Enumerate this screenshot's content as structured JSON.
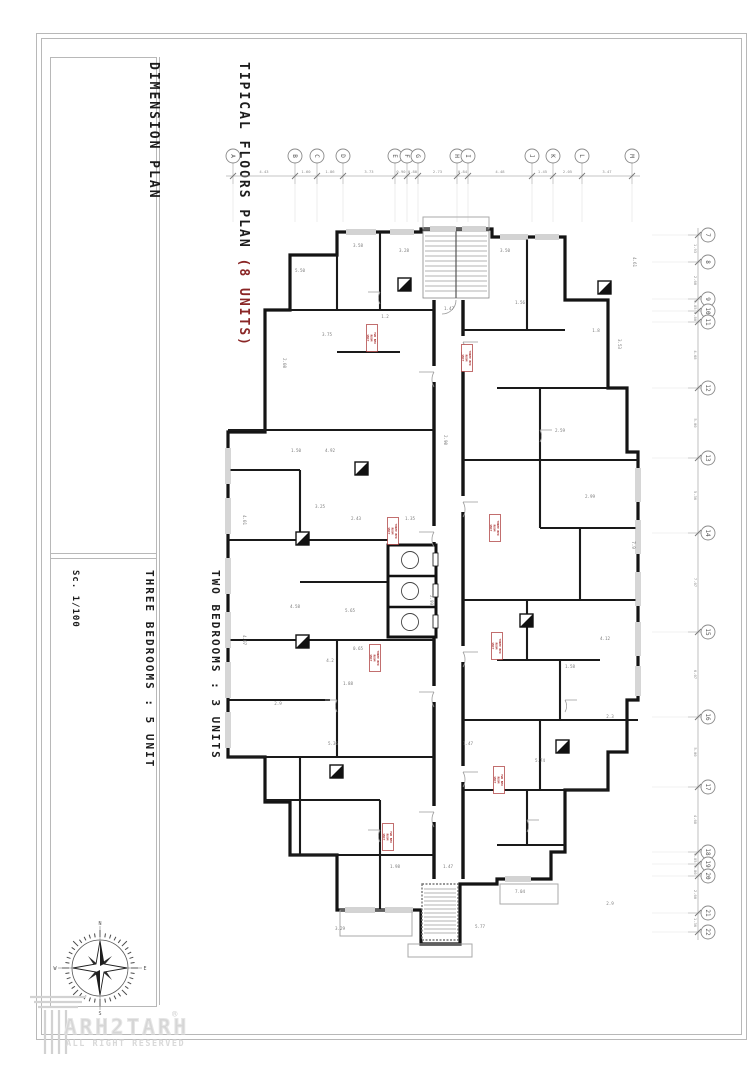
{
  "page": {
    "bg": "#ffffff",
    "frame_color": "#b8b8b8",
    "wall_color": "#141414"
  },
  "title_block": {
    "title_main": "TIPICAL FLOORS PLAN ",
    "title_accent": "(8 UNITS)",
    "accent_color": "#8a2626",
    "subtitle": "DIMENSION PLAN",
    "legend": [
      {
        "label": "TWO BEDROOMS : 3 UNITS"
      },
      {
        "label": "THREE BEDROOMS : 5 UNIT"
      }
    ],
    "scale": "Sc. 1/100"
  },
  "logo": {
    "name": "ARH2TARH",
    "registered": "®",
    "tagline": "ALL RIGHT RESERVED",
    "color": "#d6d6d6"
  },
  "compass": {
    "cardinals": {
      "n": "N",
      "e": "E",
      "s": "S",
      "w": "W"
    }
  },
  "grid": {
    "top": {
      "labels": [
        "A",
        "B",
        "C",
        "D",
        "E",
        "F",
        "G",
        "H",
        "I",
        "J",
        "K",
        "L",
        "M"
      ],
      "x": [
        233,
        295,
        317,
        343,
        395,
        407,
        418,
        457,
        468,
        532,
        553,
        582,
        632
      ],
      "dims": [
        "4.43",
        "1.60",
        "1.86",
        "3.73",
        "0.90",
        "0.80",
        "2.73",
        "0.84",
        "4.48",
        "1.45",
        "2.05",
        "3.47"
      ]
    },
    "right": {
      "labels": [
        "7",
        "8",
        "9",
        "10",
        "11",
        "12",
        "13",
        "14",
        "15",
        "16",
        "17",
        "18",
        "19",
        "20",
        "21",
        "22"
      ],
      "y": [
        235,
        262,
        299,
        311,
        322,
        388,
        458,
        533,
        632,
        717,
        787,
        852,
        864,
        876,
        913,
        932
      ],
      "dims": [
        "1.93",
        "2.60",
        "0.85",
        "0.80",
        "4.68",
        "5.00",
        "5.36",
        "7.07",
        "6.07",
        "5.00",
        "4.68",
        "0.85",
        "0.80",
        "2.60",
        "1.36"
      ]
    }
  },
  "plan": {
    "tag_color": "#a93232",
    "unit_tags": [
      {
        "x": 372,
        "y": 338,
        "lines": [
          "TWO BED",
          "ROOM",
          "UNIT"
        ]
      },
      {
        "x": 467,
        "y": 358,
        "lines": [
          "THREE BED",
          "ROOM",
          "UNIT"
        ]
      },
      {
        "x": 393,
        "y": 531,
        "lines": [
          "THREE BED",
          "ROOM",
          "UNIT"
        ]
      },
      {
        "x": 495,
        "y": 528,
        "lines": [
          "THREE BED",
          "ROOM",
          "UNIT"
        ]
      },
      {
        "x": 497,
        "y": 646,
        "lines": [
          "THREE BED",
          "ROOM",
          "UNIT"
        ]
      },
      {
        "x": 375,
        "y": 658,
        "lines": [
          "THREE BED",
          "ROOM",
          "UNIT"
        ]
      },
      {
        "x": 499,
        "y": 780,
        "lines": [
          "TWO BED",
          "ROOM",
          "UNIT"
        ]
      },
      {
        "x": 388,
        "y": 837,
        "lines": [
          "TWO BED",
          "ROOM",
          "UNIT"
        ]
      }
    ],
    "dims": [
      {
        "x": 404,
        "y": 252,
        "v": "3.28",
        "r": 0
      },
      {
        "x": 505,
        "y": 252,
        "v": "3.50",
        "r": 0
      },
      {
        "x": 300,
        "y": 272,
        "v": "5.50",
        "r": 0
      },
      {
        "x": 358,
        "y": 247,
        "v": "3.58",
        "r": 0
      },
      {
        "x": 633,
        "y": 262,
        "v": "4.61",
        "r": 1
      },
      {
        "x": 449,
        "y": 310,
        "v": "1.47",
        "r": 0
      },
      {
        "x": 385,
        "y": 318,
        "v": "1.2",
        "r": 0
      },
      {
        "x": 327,
        "y": 336,
        "v": "3.75",
        "r": 0
      },
      {
        "x": 283,
        "y": 363,
        "v": "2.08",
        "r": 1
      },
      {
        "x": 618,
        "y": 344,
        "v": "3.53",
        "r": 1
      },
      {
        "x": 520,
        "y": 304,
        "v": "1.56",
        "r": 0
      },
      {
        "x": 596,
        "y": 332,
        "v": "1.8",
        "r": 0
      },
      {
        "x": 444,
        "y": 440,
        "v": "2.90",
        "r": 1
      },
      {
        "x": 330,
        "y": 452,
        "v": "4.92",
        "r": 0
      },
      {
        "x": 296,
        "y": 452,
        "v": "1.50",
        "r": 0
      },
      {
        "x": 243,
        "y": 520,
        "v": "4.01",
        "r": 1
      },
      {
        "x": 320,
        "y": 508,
        "v": "3.25",
        "r": 0
      },
      {
        "x": 356,
        "y": 520,
        "v": "2.43",
        "r": 0
      },
      {
        "x": 410,
        "y": 520,
        "v": "1.35",
        "r": 0
      },
      {
        "x": 560,
        "y": 432,
        "v": "2.59",
        "r": 0
      },
      {
        "x": 590,
        "y": 498,
        "v": "2.99",
        "r": 0
      },
      {
        "x": 632,
        "y": 545,
        "v": "7.9",
        "r": 1
      },
      {
        "x": 295,
        "y": 608,
        "v": "4.58",
        "r": 0
      },
      {
        "x": 350,
        "y": 612,
        "v": "5.65",
        "r": 0
      },
      {
        "x": 243,
        "y": 640,
        "v": "4.07",
        "r": 1
      },
      {
        "x": 330,
        "y": 662,
        "v": "4.2",
        "r": 0
      },
      {
        "x": 358,
        "y": 650,
        "v": "0.65",
        "r": 0
      },
      {
        "x": 348,
        "y": 685,
        "v": "1.88",
        "r": 0
      },
      {
        "x": 278,
        "y": 705,
        "v": "2.9",
        "r": 0
      },
      {
        "x": 333,
        "y": 745,
        "v": "5.36",
        "r": 0
      },
      {
        "x": 605,
        "y": 640,
        "v": "4.12",
        "r": 0
      },
      {
        "x": 570,
        "y": 668,
        "v": "1.58",
        "r": 0
      },
      {
        "x": 610,
        "y": 718,
        "v": "2.3",
        "r": 0
      },
      {
        "x": 468,
        "y": 745,
        "v": "1.47",
        "r": 0
      },
      {
        "x": 540,
        "y": 762,
        "v": "5.74",
        "r": 0
      },
      {
        "x": 520,
        "y": 893,
        "v": "7.04",
        "r": 0
      },
      {
        "x": 480,
        "y": 928,
        "v": "5.77",
        "r": 0
      },
      {
        "x": 340,
        "y": 930,
        "v": "3.29",
        "r": 0
      },
      {
        "x": 610,
        "y": 905,
        "v": "2.9",
        "r": 0
      },
      {
        "x": 448,
        "y": 868,
        "v": "1.47",
        "r": 0
      },
      {
        "x": 395,
        "y": 868,
        "v": "1.98",
        "r": 0
      },
      {
        "x": 430,
        "y": 600,
        "v": "2.99",
        "r": 1
      }
    ]
  }
}
